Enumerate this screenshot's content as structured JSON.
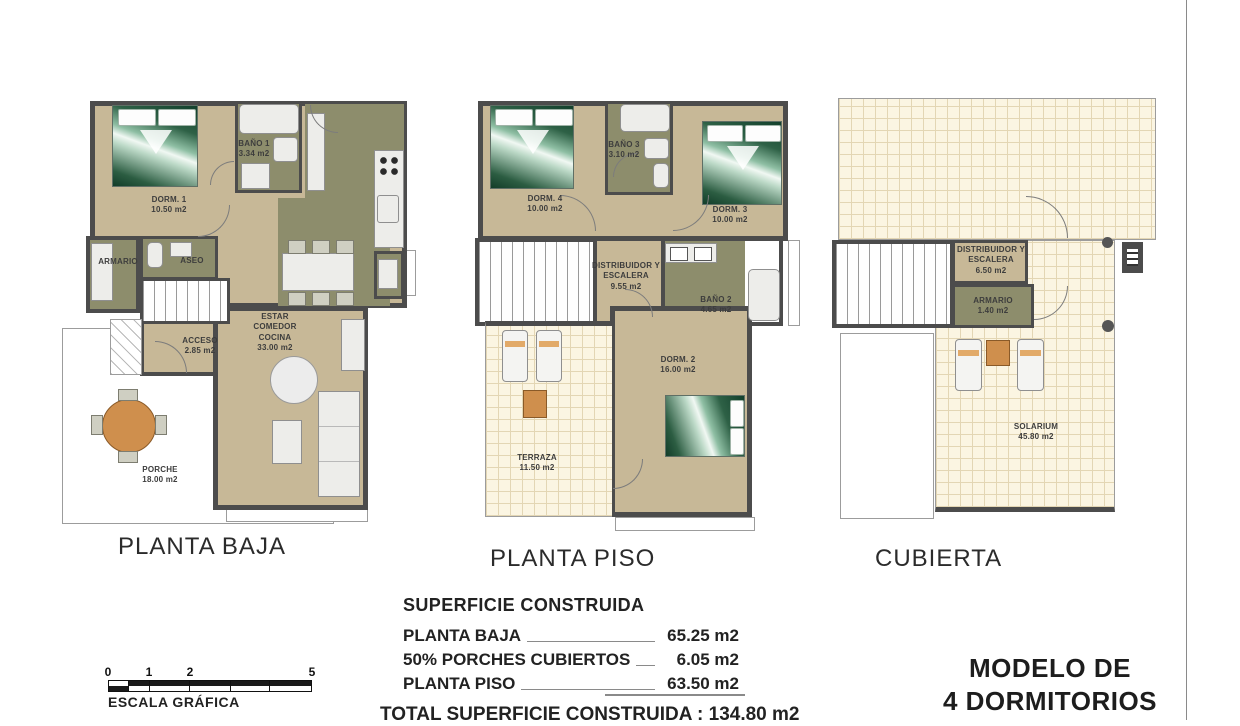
{
  "palette": {
    "floor_beige": "#c7b897",
    "room_olive": "#8d8d6c",
    "wall_gray": "#4c4c4c",
    "tile_cream": "#fbf5e2",
    "wood_orange": "#cf8f4d",
    "bed_green": "#2e6146"
  },
  "plans": [
    {
      "title": "PLANTA BAJA",
      "rooms": [
        {
          "name": "DORM. 1",
          "area": "10.50 m2"
        },
        {
          "name": "BAÑO 1",
          "area": "3.34 m2"
        },
        {
          "name": "ARMARIO",
          "area": ""
        },
        {
          "name": "ASEO",
          "area": ""
        },
        {
          "name": "ACCESO",
          "area": "2.85 m2"
        },
        {
          "name": "ESTAR COMEDOR COCINA",
          "area": "33.00 m2"
        },
        {
          "name": "PORCHE",
          "area": "18.00 m2"
        }
      ]
    },
    {
      "title": "PLANTA PISO",
      "rooms": [
        {
          "name": "DORM. 4",
          "area": "10.00 m2"
        },
        {
          "name": "BAÑO 3",
          "area": "3.10 m2"
        },
        {
          "name": "DORM. 3",
          "area": "10.00 m2"
        },
        {
          "name": "DISTRIBUIDOR Y ESCALERA",
          "area": "9.55 m2"
        },
        {
          "name": "BAÑO 2",
          "area": "4.65 m2"
        },
        {
          "name": "DORM. 2",
          "area": "16.00 m2"
        },
        {
          "name": "TERRAZA",
          "area": "11.50 m2"
        }
      ]
    },
    {
      "title": "CUBIERTA",
      "rooms": [
        {
          "name": "DISTRIBUIDOR Y ESCALERA",
          "area": "6.50 m2"
        },
        {
          "name": "ARMARIO",
          "area": "1.40 m2"
        },
        {
          "name": "SOLARIUM",
          "area": "45.80 m2"
        }
      ]
    }
  ],
  "summary": {
    "title": "SUPERFICIE CONSTRUIDA",
    "rows": [
      {
        "label": "PLANTA BAJA",
        "value": "65.25 m2"
      },
      {
        "label": "50% PORCHES CUBIERTOS",
        "value": "6.05 m2"
      },
      {
        "label": "PLANTA PISO",
        "value": "63.50 m2"
      }
    ],
    "total": "TOTAL SUPERFICIE CONSTRUIDA : 134.80 m2"
  },
  "scale_bar": {
    "label": "ESCALA GRÁFICA",
    "ticks": [
      "0",
      "1",
      "2",
      "5"
    ]
  },
  "model": {
    "line1": "MODELO DE",
    "line2": "4 DORMITORIOS"
  }
}
